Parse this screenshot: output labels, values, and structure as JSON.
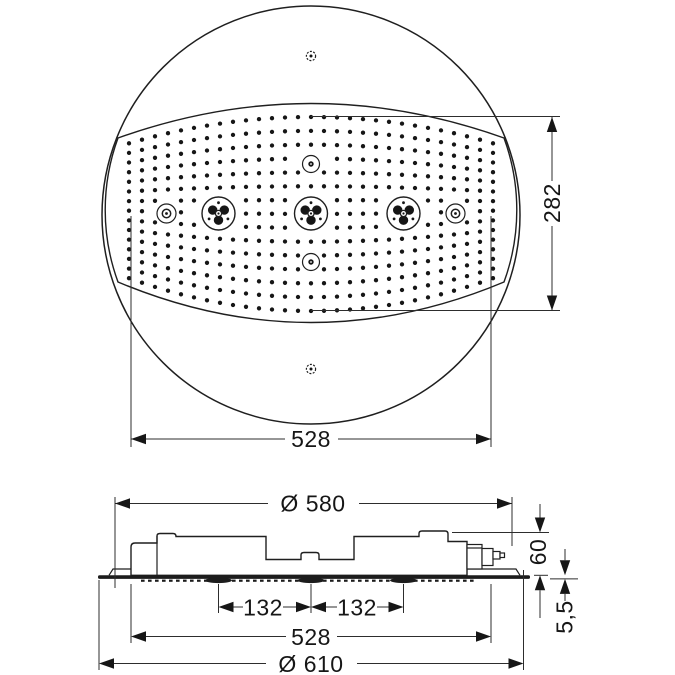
{
  "drawing": {
    "top_view": {
      "dim_face_height": "282",
      "dim_face_width": "528"
    },
    "side_view": {
      "dim_body_diameter": "Ø 580",
      "dim_install_height": "60",
      "dim_plate_thickness": "5,5",
      "dim_cluster_left": "132",
      "dim_cluster_right": "132",
      "dim_nozzle_span": "528",
      "dim_plate_diameter": "Ø 610"
    }
  }
}
